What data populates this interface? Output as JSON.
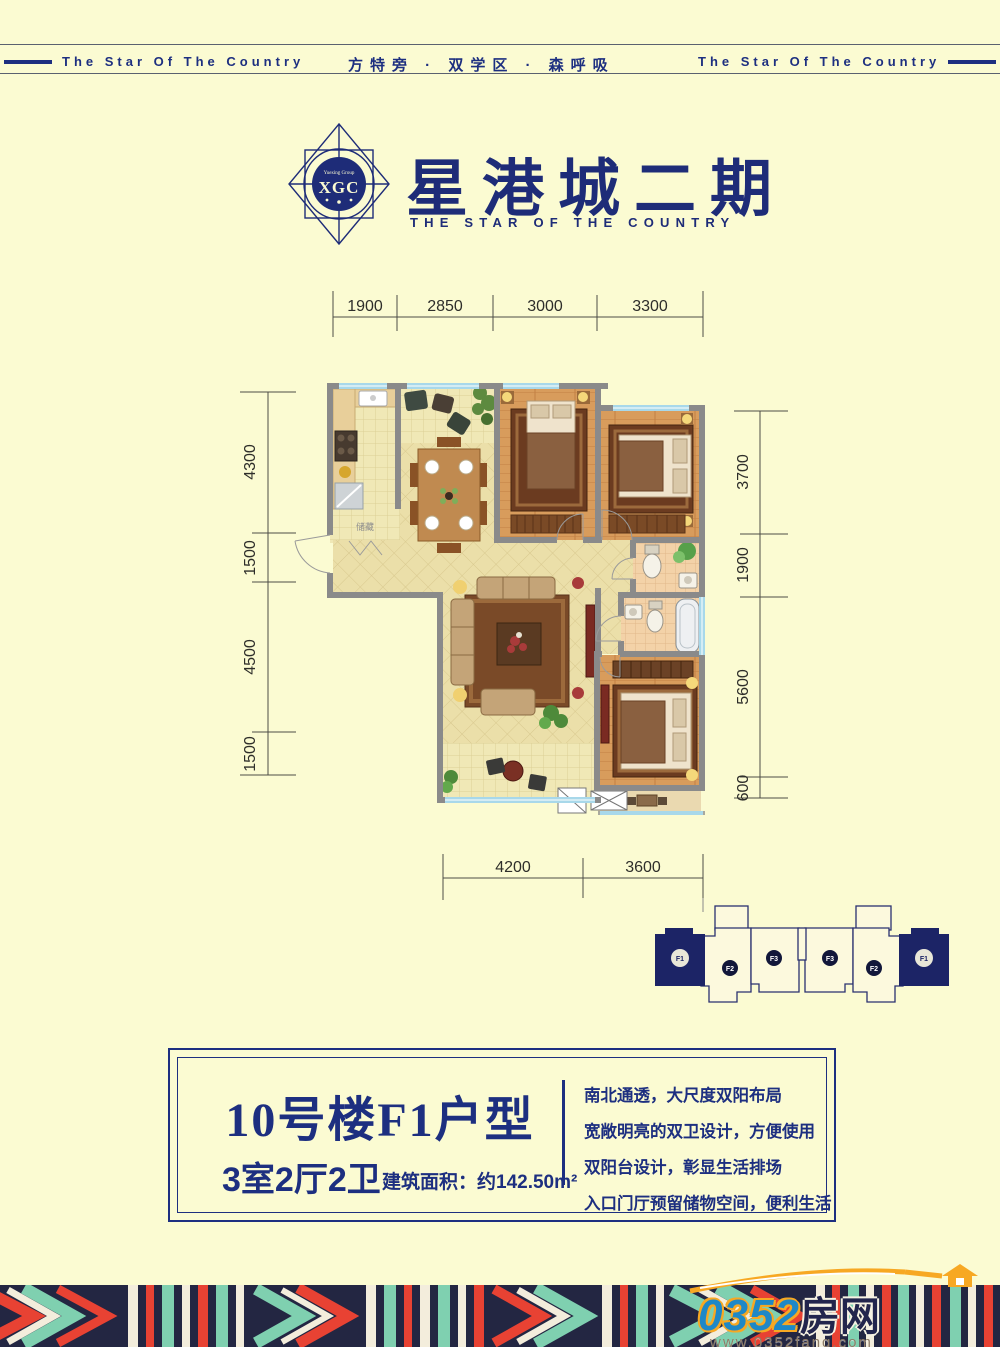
{
  "header": {
    "left_tagline": "The Star Of The Country",
    "center_tagline": "方特旁 · 双学区 · 森呼吸",
    "right_tagline": "The Star Of The Country"
  },
  "logo": {
    "emblem_group": "Yuexing Group",
    "emblem_initials": "XGC",
    "title": "星港城二期",
    "subtitle": "THE STAR OF THE COUNTRY"
  },
  "floorplan": {
    "dims_top": [
      "1900",
      "2850",
      "3000",
      "3300"
    ],
    "dims_left": [
      "4300",
      "1500",
      "4500",
      "1500"
    ],
    "dims_right": [
      "3700",
      "1900",
      "5600",
      "600"
    ],
    "dims_bottom": [
      "4200",
      "3600"
    ],
    "storage_label": "储藏"
  },
  "keyplan": {
    "units": [
      "F1",
      "F2",
      "F3",
      "F3",
      "F2",
      "F1"
    ]
  },
  "infobox": {
    "title": "10号楼F1户型",
    "rooms": "3室2厅2卫",
    "area": "建筑面积：约142.50m²",
    "features": [
      "南北通透，大尺度双阳布局",
      "宽敞明亮的双卫设计，方便使用",
      "双阳台设计，彰显生活排场",
      "入口门厅预留储物空间，便利生活"
    ]
  },
  "footer": {
    "site_number": "0352",
    "site_suffix": "房网",
    "website": "www.0352fang.com"
  },
  "colors": {
    "navy": "#1d2f80",
    "cream": "#fbfbd2",
    "wall_gray": "#8a8a8a",
    "strip_navy": "#232642",
    "strip_red": "#e84233",
    "strip_teal": "#7fd0b0",
    "logo_orange": "#f7a823",
    "logo_blue": "#1e88c7"
  }
}
